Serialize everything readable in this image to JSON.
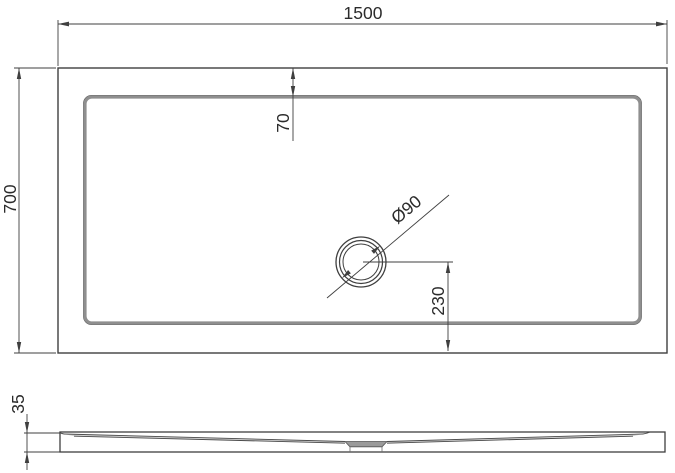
{
  "drawing": {
    "kind": "technical-dimension-drawing",
    "subject": "rectangular shower tray, plan view and side profile view",
    "views": {
      "plan": {
        "length_dim": "1500",
        "width_dim": "700",
        "drain_top_offset_dim": "70",
        "drain_diameter_dim": "Ø90",
        "drain_bottom_offset_dim": "230"
      },
      "side": {
        "thickness_dim": "35"
      }
    },
    "colors": {
      "line": "#3f3f3f",
      "rim_band": "#8f8f8f",
      "drain_pocket": "#9a9a9a",
      "text": "#2b2b2b",
      "background": "#ffffff"
    }
  }
}
